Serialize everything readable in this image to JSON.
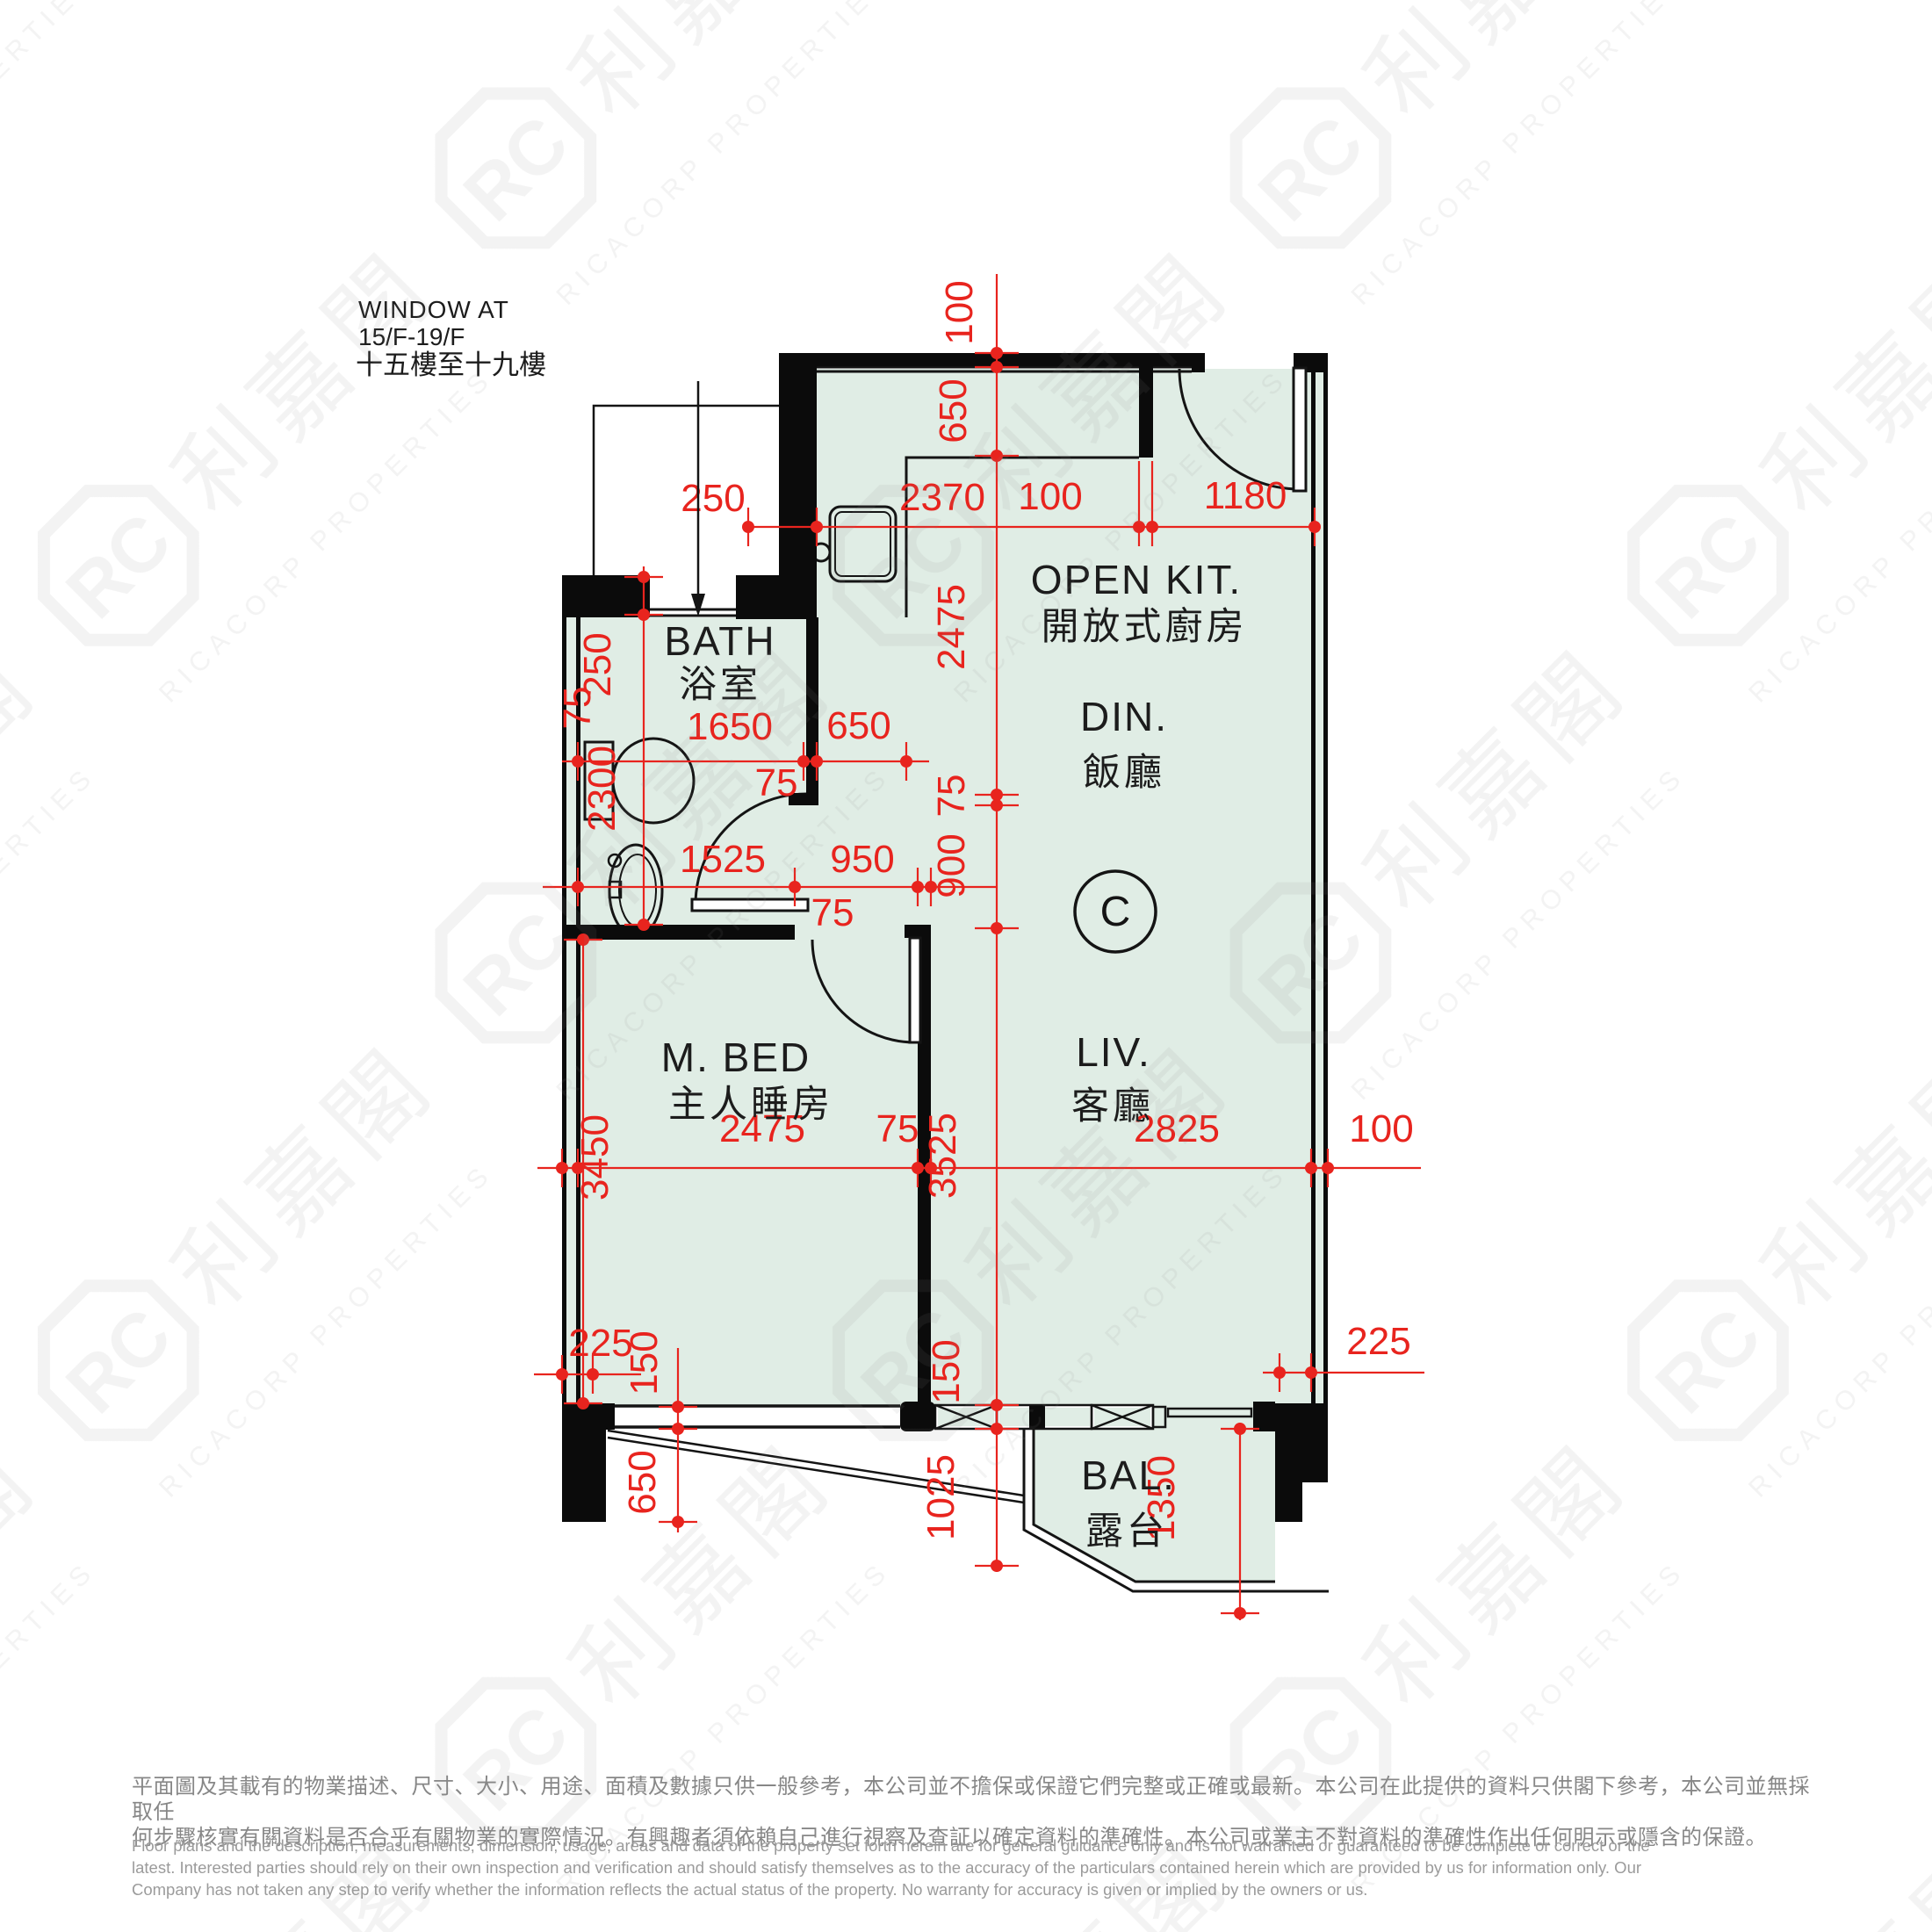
{
  "colors": {
    "floor": "#e0ede5",
    "wall": "#0b0b0b",
    "dimension_red": "#e8241e",
    "watermark_gray": "#888888",
    "footer_zh": "#878787",
    "footer_en": "#9b9b9b"
  },
  "watermark": {
    "monogram": "RC",
    "cjk": "利嘉閣",
    "latin": "RICACORP PROPERTIES"
  },
  "window_note": {
    "line1": "WINDOW AT",
    "line2": "15/F-19/F",
    "line3": "十五樓至十九樓"
  },
  "unit_marker": "C",
  "rooms": {
    "open_kitchen": {
      "en": "OPEN KIT.",
      "zh": "開放式廚房"
    },
    "dining": {
      "en": "DIN.",
      "zh": "飯廳"
    },
    "living": {
      "en": "LIV.",
      "zh": "客廳"
    },
    "master_bedroom": {
      "en": "M. BED",
      "zh": "主人睡房"
    },
    "bathroom": {
      "en": "BATH",
      "zh": "浴室"
    },
    "balcony": {
      "en": "BAL.",
      "zh": "露台"
    }
  },
  "dims": [
    "100",
    "650",
    "2475",
    "75",
    "900",
    "3525",
    "150",
    "1025",
    "250",
    "2370",
    "100",
    "1180",
    "250",
    "2300",
    "75",
    "1650",
    "650",
    "75",
    "1525",
    "950",
    "75",
    "3450",
    "2475",
    "75",
    "2825",
    "100",
    "225",
    "150",
    "650",
    "225",
    "1350"
  ],
  "disclaimer": {
    "zh": [
      "平面圖及其載有的物業描述、尺寸、大小、用途、面積及數據只供一般參考，本公司並不擔保或保證它們完整或正確或最新。本公司在此提供的資料只供閣下參考，本公司並無採取任",
      "何步驟核實有關資料是否合乎有關物業的實際情況。有興趣者須依賴自己進行視察及查証以確定資料的準確性。本公司或業主不對資料的準確性作出任何明示或隱含的保證。"
    ],
    "en": [
      "Floor plans and the description, measurements, dimension, usage, areas and data of the property set forth herein are for general guidance only and Is not warranted or guaranteed to be complete or correct or the",
      "latest. Interested parties should rely on their own inspection and verification and should satisfy themselves as to the accuracy of the particulars contained herein which are provided by us for information only.  Our",
      "Company has not taken any step to verify whether the information reflects the actual status of the property.  No warranty for accuracy is given or implied by the owners or us."
    ]
  }
}
